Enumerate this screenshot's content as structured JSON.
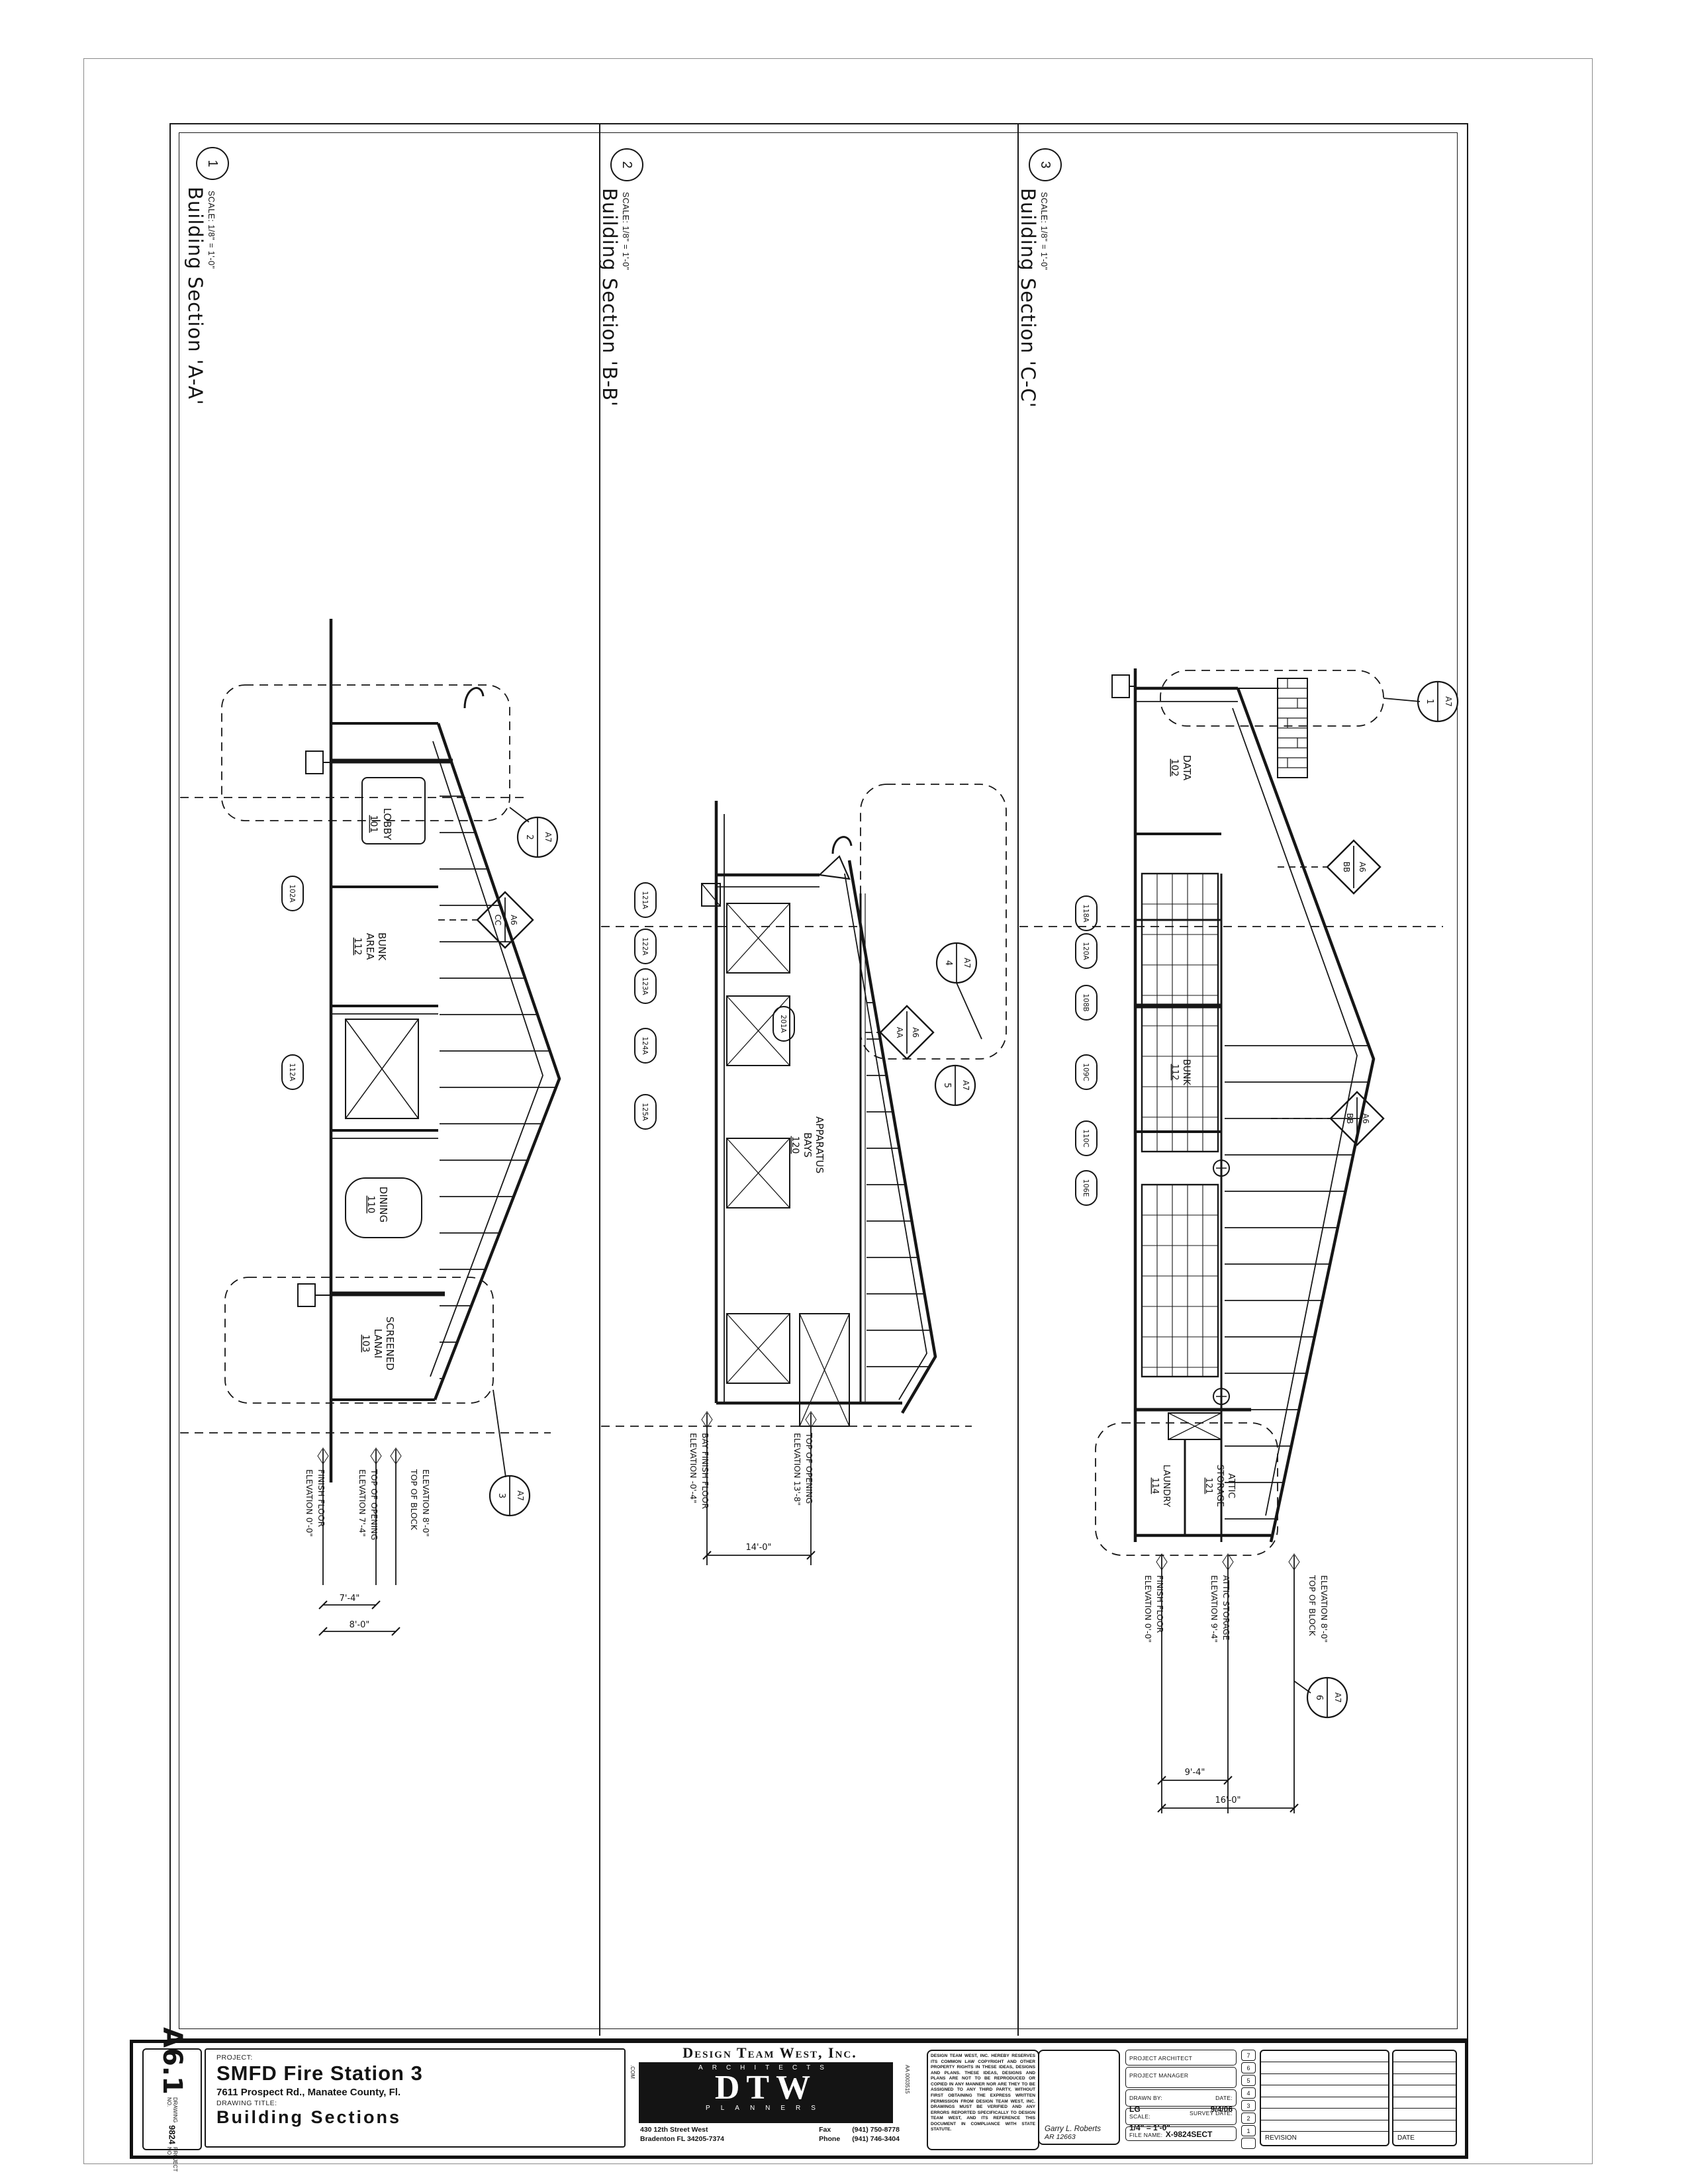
{
  "page": {
    "sections": [
      {
        "id": "1",
        "title": "Building Section 'A-A'",
        "scale": "SCALE: 1/8\" = 1'-0\"",
        "rooms": [
          {
            "l1": "LOBBY",
            "l2": "",
            "num": "101"
          },
          {
            "l1": "BUNK",
            "l2": "AREA",
            "num": "112"
          },
          {
            "l1": "DINING",
            "l2": "",
            "num": "110"
          },
          {
            "l1": "SCREENED",
            "l2": "LANAI",
            "num": "103"
          }
        ],
        "tags": [
          "102A",
          "112A"
        ],
        "detail_refs": [
          {
            "num": "2",
            "sheet": "A7"
          },
          {
            "num": "3",
            "sheet": "A7"
          }
        ],
        "section_refs": [
          {
            "num": "CC",
            "sheet": "A6"
          }
        ],
        "elevations": [
          {
            "l1": "FINISH FLOOR",
            "l2": "ELEVATION 0'-0\""
          },
          {
            "l1": "TOP OF OPENING",
            "l2": "ELEVATION 7'-4\""
          },
          {
            "l1": "TOP OF BLOCK",
            "l2": "ELEVATION 8'-0\""
          }
        ],
        "dims": [
          "7'-4\"",
          "8'-0\""
        ]
      },
      {
        "id": "2",
        "title": "Building Section 'B-B'",
        "scale": "SCALE: 1/8\" = 1'-0\"",
        "rooms": [
          {
            "l1": "APPARATUS",
            "l2": "BAYS",
            "num": "120"
          }
        ],
        "tags": [
          "121A",
          "122A",
          "123A",
          "124A",
          "125A"
        ],
        "inner_tags": [
          "201A"
        ],
        "detail_refs": [
          {
            "num": "4",
            "sheet": "A7"
          },
          {
            "num": "5",
            "sheet": "A7"
          }
        ],
        "section_refs": [
          {
            "num": "AA",
            "sheet": "A6"
          }
        ],
        "elevations": [
          {
            "l1": "BAY FINISH FLOOR",
            "l2": "ELEVATION -0'-4\""
          },
          {
            "l1": "TOP OF OPENING",
            "l2": "ELEVATION 13'-8\""
          }
        ],
        "dims": [
          "14'-0\""
        ]
      },
      {
        "id": "3",
        "title": "Building Section 'C-C'",
        "scale": "SCALE: 1/8\" = 1'-0\"",
        "rooms": [
          {
            "l1": "DATA",
            "l2": "",
            "num": "102"
          },
          {
            "l1": "BUNK",
            "l2": "",
            "num": "112"
          },
          {
            "l1": "LAUNDRY",
            "l2": "",
            "num": "114"
          },
          {
            "l1": "ATTIC",
            "l2": "STORAGE",
            "num": "121"
          }
        ],
        "tags": [
          "118A",
          "120A",
          "108B",
          "109C",
          "110C",
          "106E"
        ],
        "detail_refs": [
          {
            "num": "1",
            "sheet": "A7"
          },
          {
            "num": "6",
            "sheet": "A7"
          }
        ],
        "section_refs": [
          {
            "num": "BB",
            "sheet": "A6"
          },
          {
            "num": "BB",
            "sheet": "A6"
          }
        ],
        "elevations": [
          {
            "l1": "FINISH FLOOR",
            "l2": "ELEVATION 0'-0\""
          },
          {
            "l1": "ATTIC STORAGE",
            "l2": "ELEVATION 9'-4\""
          },
          {
            "l1": "TOP OF BLOCK",
            "l2": "ELEVATION 8'-0\""
          }
        ],
        "dims": [
          "9'-4\"",
          "16'-0\""
        ]
      }
    ],
    "title_block": {
      "drawing_no_label": "DRAWING NO.",
      "drawing_no": "A6.1",
      "project_no_label": "PROJECT NO.",
      "project_no": "9824",
      "project_label": "PROJECT:",
      "project_name": "SMFD Fire Station 3",
      "project_address": "7611 Prospect Rd., Manatee County, Fl.",
      "drawing_title_label": "DRAWING TITLE:",
      "drawing_title": "Building Sections",
      "firm": {
        "name": "Design Team West, Inc.",
        "logo": "DTW",
        "logo_top": "ARCHITECTS",
        "logo_bottom": "PLANNERS",
        "side_left": ".COM",
        "side_right": "AA 0003515",
        "address1": "430 12th Street West",
        "address2": "Bradenton FL 34205-7374",
        "fax_label": "Fax",
        "fax": "(941) 750-8778",
        "phone_label": "Phone",
        "phone": "(941) 746-3404"
      },
      "disclaimer": "DESIGN TEAM WEST, INC. HEREBY RESERVES ITS COMMON LAW COPYRIGHT AND OTHER PROPERTY RIGHTS IN THESE IDEAS, DESIGNS AND PLANS. THESE IDEAS, DESIGNS AND PLANS ARE NOT TO BE REPRODUCED OR COPIED IN ANY MANNER NOR ARE THEY TO BE ASSIGNED TO ANY THIRD PARTY, WITHOUT FIRST OBTAINING THE EXPRESS WRITTEN PERMISSION FROM DESIGN TEAM WEST, INC. DRAWINGS MUST BE VERIFIED AND ANY ERRORS REPORTED SPECIFICALLY TO DESIGN TEAM WEST, AND ITS REFERENCE THIS DOCUMENT IN COMPLIANCE WITH STATE STATUTE.",
      "architect_name": "Garry L. Roberts",
      "architect_lic": "AR 12663",
      "fields": {
        "project_architect_label": "PROJECT ARCHITECT",
        "project_manager_label": "PROJECT MANAGER",
        "drawn_by_label": "DRAWN BY:",
        "drawn_by": "LG",
        "date_label": "DATE:",
        "date": "9/4/06",
        "scale_label": "SCALE:",
        "scale": "1/4\" = 1'-0\"",
        "survey_date_label": "SURVEY DATE:",
        "file_name_label": "FILE NAME:",
        "file_name": "X-9824SECT"
      },
      "revision": {
        "numbers": [
          "7",
          "6",
          "5",
          "4",
          "3",
          "2",
          "1"
        ],
        "revision_label": "REVISION",
        "date_label": "DATE"
      }
    }
  }
}
